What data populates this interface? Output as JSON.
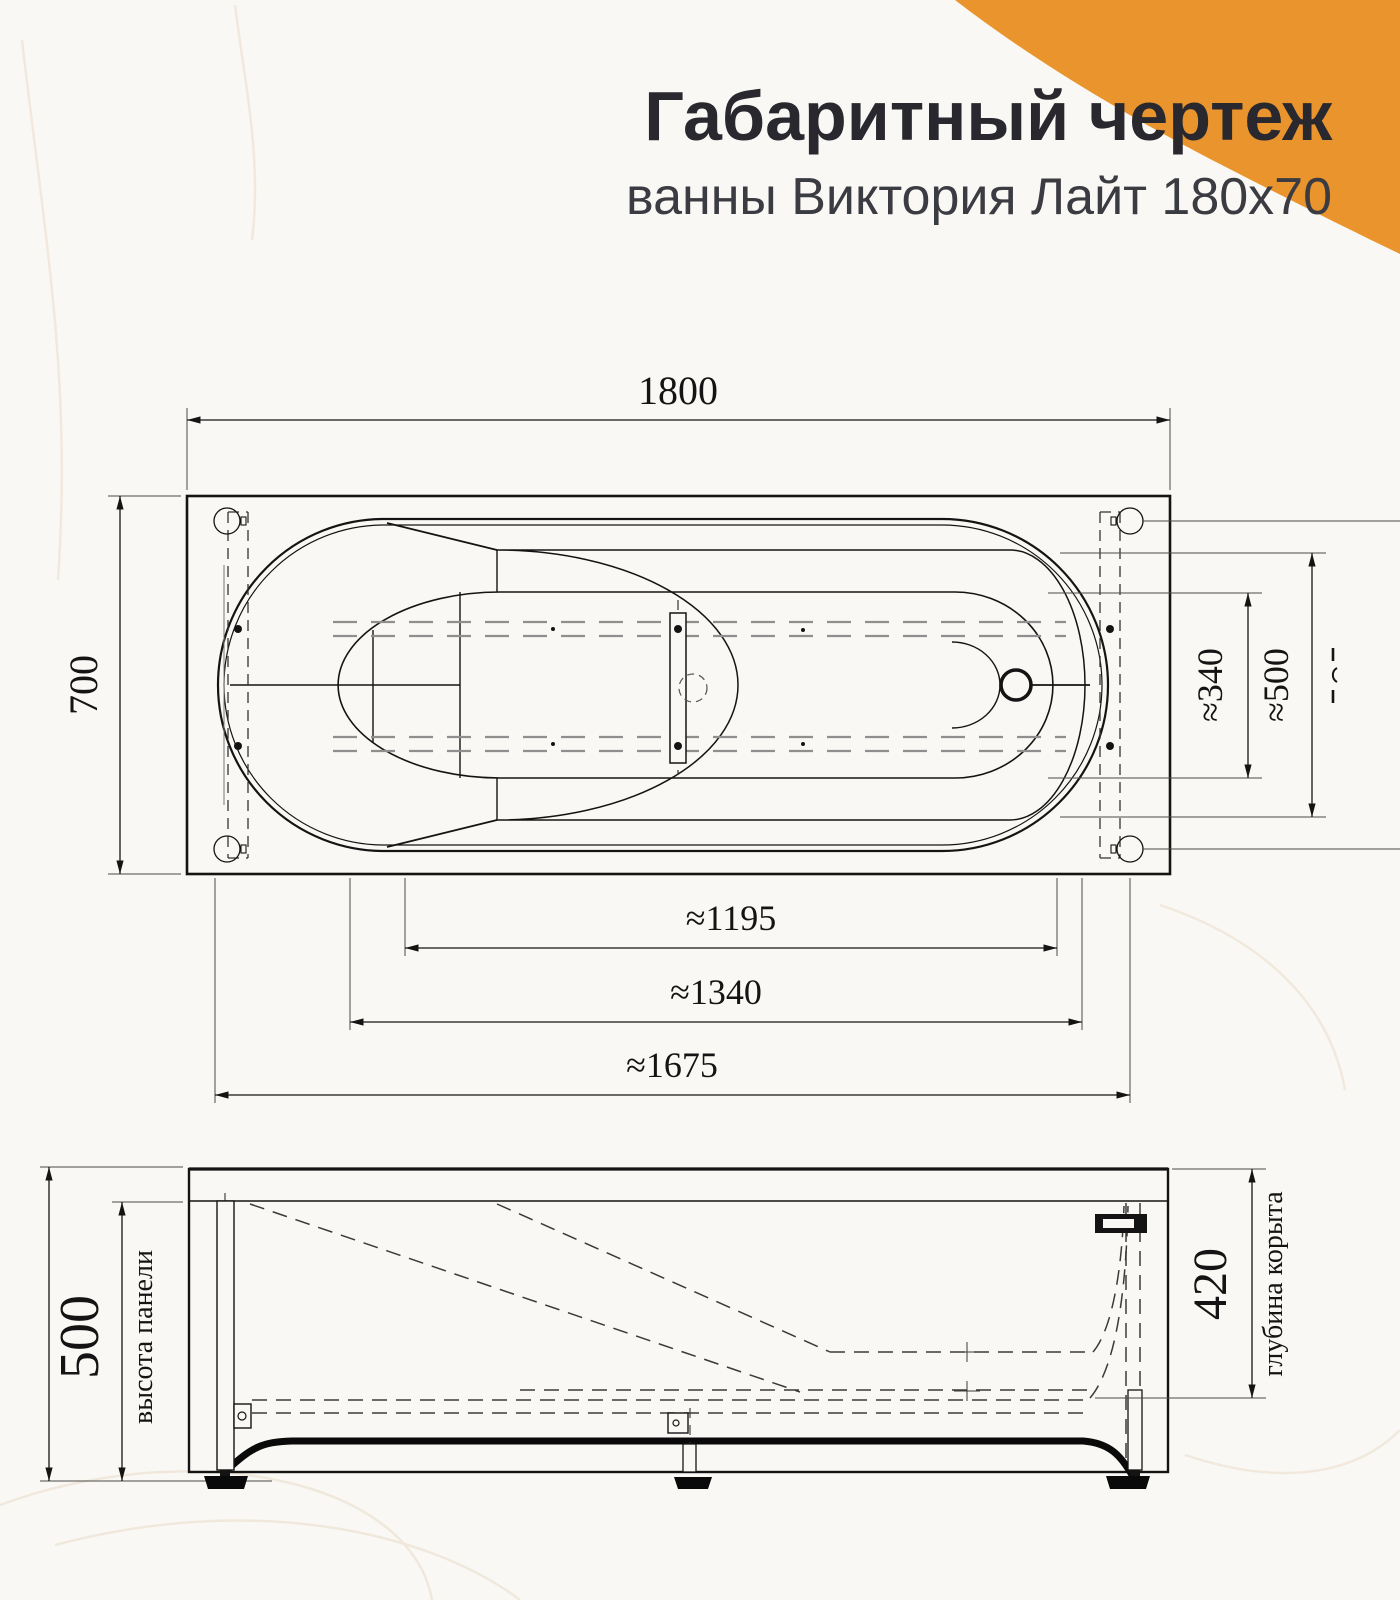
{
  "colors": {
    "background": "#FAF8F4",
    "accent_orange": "#E9942D",
    "ink": "#141414",
    "header_text": "#28282E",
    "subtitle_text": "#3B3B42"
  },
  "header": {
    "title": "Габаритный чертеж",
    "subtitle": "ванны Виктория Лайт 180x70"
  },
  "top_view": {
    "length": "1800",
    "width": "700",
    "rim_spacing_inner": "≈340",
    "rim_spacing_outer": "≈500",
    "bottom_span_1": "≈1195",
    "bottom_span_2": "≈1340",
    "bottom_span_3": "≈1675",
    "right_edge_clipped_label": "≈"
  },
  "side_view": {
    "panel_height": "500",
    "panel_height_label": "высота панели",
    "bowl_depth": "420",
    "bowl_depth_label": "глубина корыта"
  }
}
